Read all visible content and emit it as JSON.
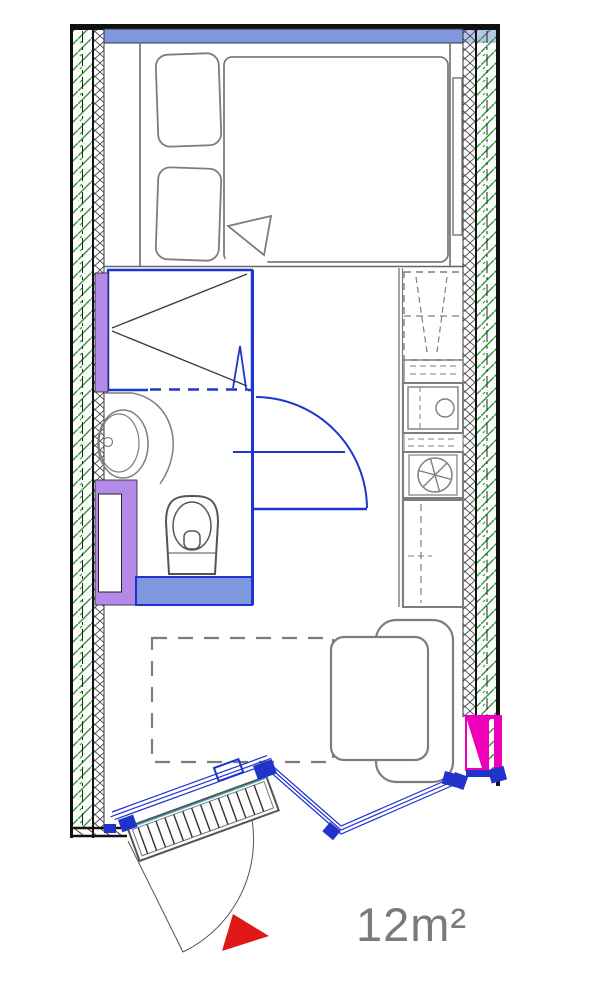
{
  "floorplan": {
    "area_label": "12m²",
    "colors": {
      "structural_wall": "#111111",
      "insulation_hatch_green": "#2f9a33",
      "inner_lining_crosshatch": "#4a4a4a",
      "window_sill_blue": "#7e97de",
      "window_sill_blue_light": "#b9c4ec",
      "plumbing_fixture_blue": "#1c36cf",
      "wet_zone_purple": "#b48ae8",
      "entry_panel_magenta": "#ee00bb",
      "railing_blue": "#2233cc",
      "furniture_outline_gray": "#7d7d7d",
      "entrance_arrow_red": "#e01818",
      "area_label_gray": "#7a7a7a"
    },
    "elements": [
      "window-sill",
      "double-bed",
      "pillows",
      "mattress-fold",
      "bedside-shelf",
      "shower-cabin",
      "shower-door",
      "washbasin",
      "vanity-counter",
      "toilet",
      "bathroom-door-swing",
      "towel-rail",
      "kitchen-counter",
      "upper-cabinets",
      "kitchen-sink",
      "extractor-hob",
      "refrigerator",
      "fold-out-bed-outline",
      "armchair",
      "gangway-ladder",
      "railing",
      "entry-hatch",
      "entry-door-swing",
      "entrance-arrow",
      "area-label"
    ]
  }
}
